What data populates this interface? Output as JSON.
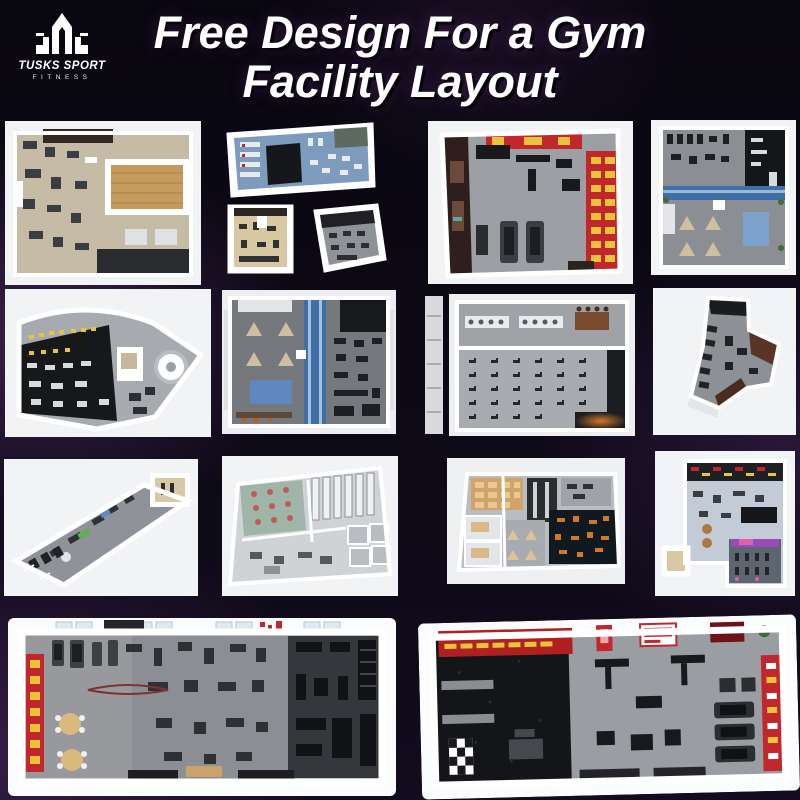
{
  "brand": {
    "name": "TUSKS SPORT",
    "sub": "FITNESS",
    "logo_icon": "tusks-logo-icon"
  },
  "title": {
    "line1": "Free Design For a Gym",
    "line2": "Facility Layout"
  },
  "colors": {
    "background": "#0d0916",
    "glow": "#5a3472",
    "title": "#ffffff",
    "card": "#f2f3f5",
    "accent_red": "#c1272d",
    "accent_yellow": "#e8c43a",
    "accent_blue": "#5f87c0",
    "runway_blue": "#3f6fa6",
    "floor_gray": "#8d9095",
    "floor_beige": "#c6bca6",
    "floor_black": "#141518",
    "floor_wood": "#c79a5e"
  },
  "gallery": {
    "icons": [
      {
        "name": "beige-floor-gym-plan"
      },
      {
        "name": "blue-floor-gym-plan-wide"
      },
      {
        "name": "tan-floor-small-gym-plan"
      },
      {
        "name": "gray-floor-small-gym-plan"
      },
      {
        "name": "red-banner-cardio-room-plan"
      },
      {
        "name": "blue-runway-studio-plan"
      },
      {
        "name": "fan-shaped-black-floor-gym-plan"
      },
      {
        "name": "blue-runway-studio-plan-2"
      },
      {
        "name": "spin-class-studio-plan"
      },
      {
        "name": "angular-dark-gym-plan"
      },
      {
        "name": "long-corridor-gym-plan"
      },
      {
        "name": "multi-room-facility-plan"
      },
      {
        "name": "orange-accent-club-plan"
      },
      {
        "name": "blue-floor-club-plan"
      },
      {
        "name": "large-gray-carpet-gym-plan"
      },
      {
        "name": "large-black-and-gray-gym-plan"
      }
    ]
  }
}
